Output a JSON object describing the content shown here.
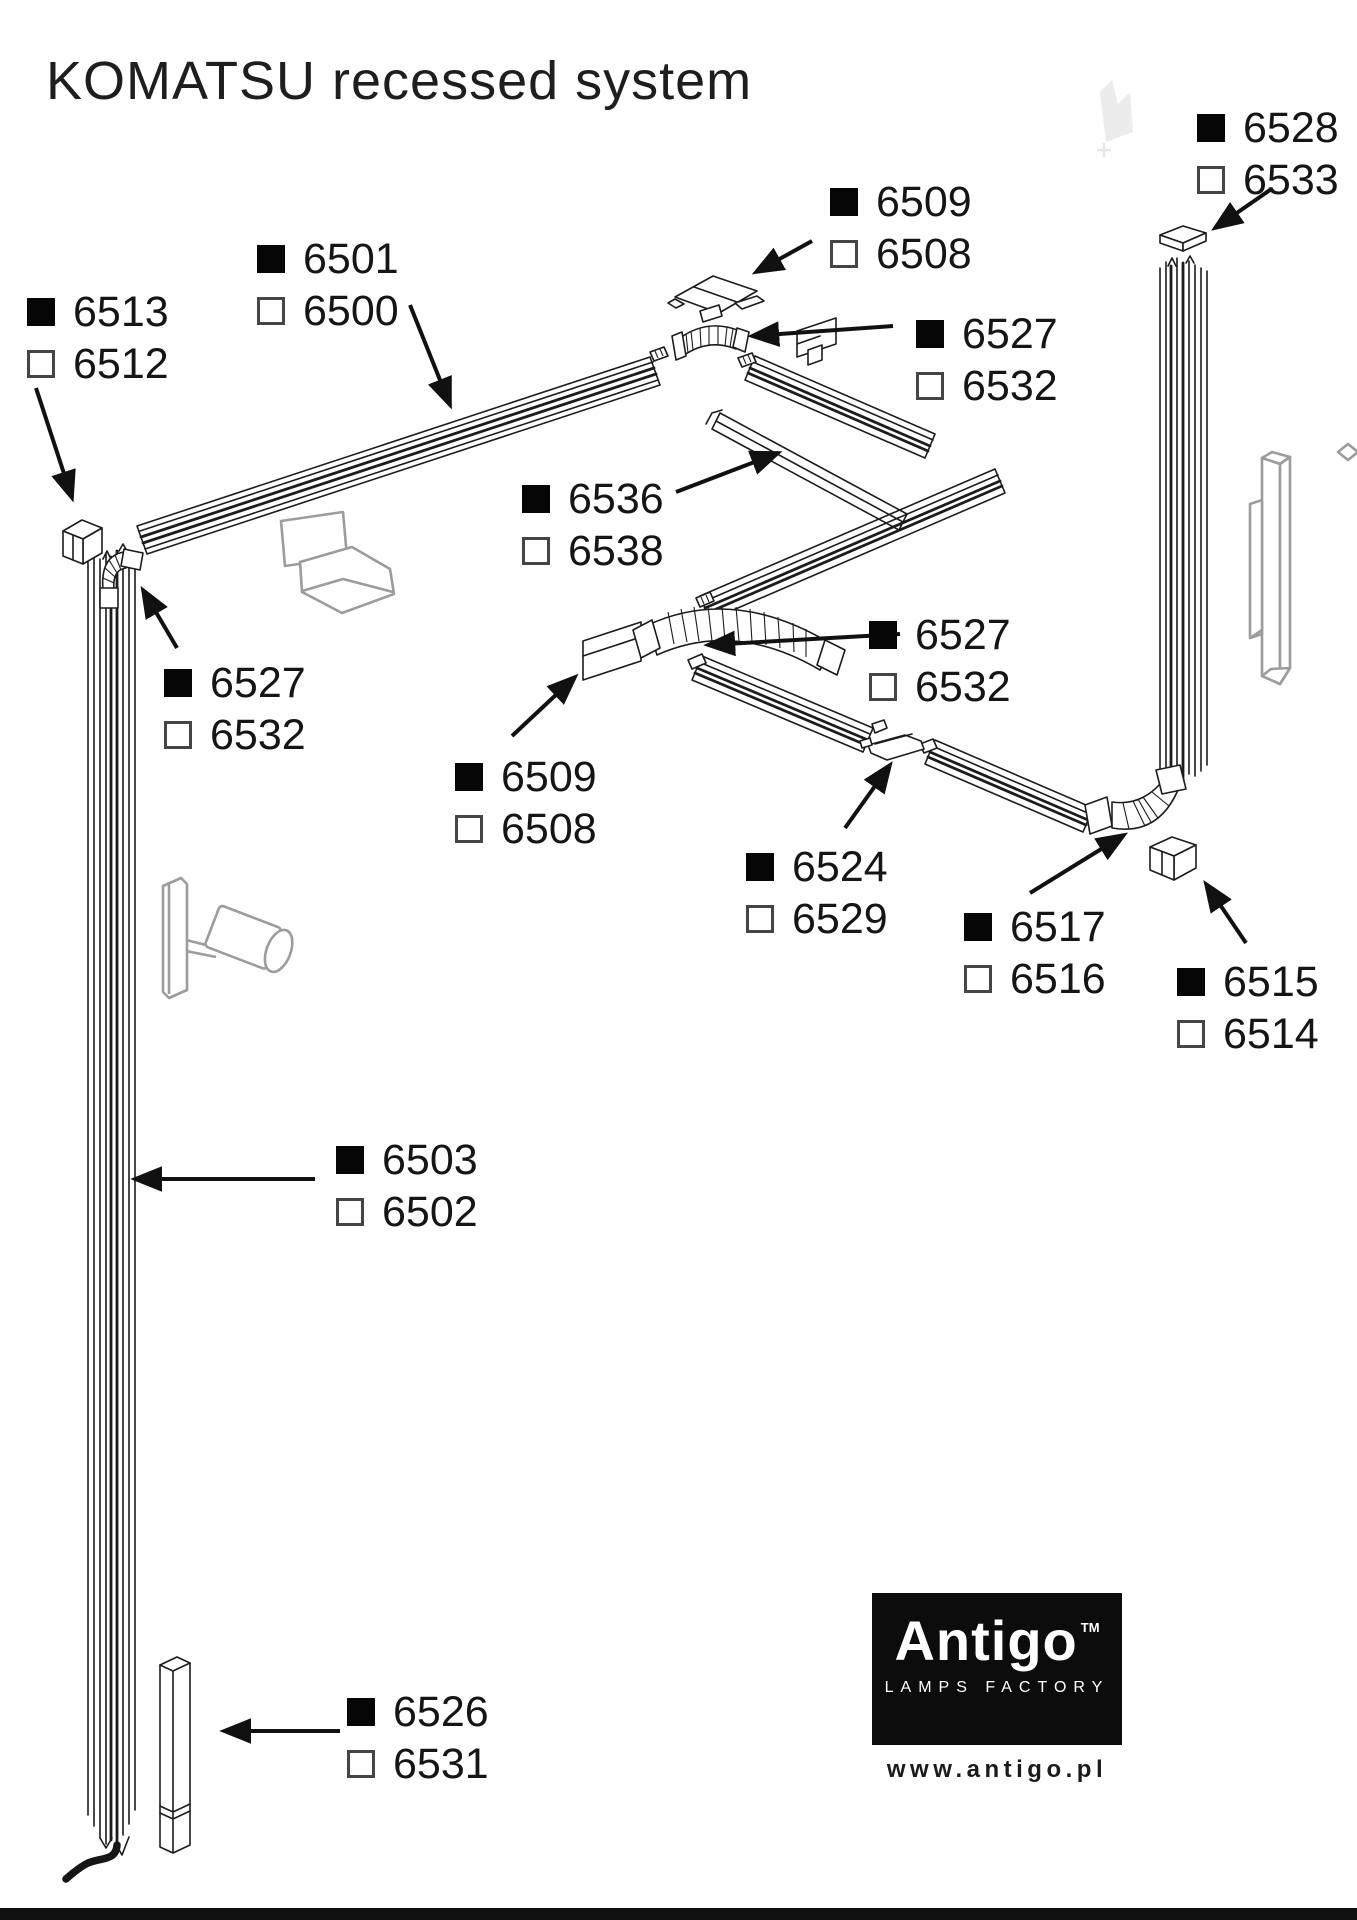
{
  "title": "KOMATSU recessed system",
  "labels": [
    {
      "id": "6513-6512",
      "black": "6513",
      "white": "6512"
    },
    {
      "id": "6501-6500",
      "black": "6501",
      "white": "6500"
    },
    {
      "id": "6509-6508-a",
      "black": "6509",
      "white": "6508"
    },
    {
      "id": "6528-6533",
      "black": "6528",
      "white": "6533"
    },
    {
      "id": "6527-6532-a",
      "black": "6527",
      "white": "6532"
    },
    {
      "id": "6536-6538",
      "black": "6536",
      "white": "6538"
    },
    {
      "id": "6527-6532-b",
      "black": "6527",
      "white": "6532"
    },
    {
      "id": "6527-6532-c",
      "black": "6527",
      "white": "6532"
    },
    {
      "id": "6509-6508-b",
      "black": "6509",
      "white": "6508"
    },
    {
      "id": "6524-6529",
      "black": "6524",
      "white": "6529"
    },
    {
      "id": "6517-6516",
      "black": "6517",
      "white": "6516"
    },
    {
      "id": "6515-6514",
      "black": "6515",
      "white": "6514"
    },
    {
      "id": "6503-6502",
      "black": "6503",
      "white": "6502"
    },
    {
      "id": "6526-6531",
      "black": "6526",
      "white": "6531"
    }
  ],
  "logo": {
    "brand": "Antigo",
    "trademark": "TM",
    "tagline": "LAMPS FACTORY",
    "website": "www.antigo.pl"
  },
  "colors": {
    "line": "#1c1c1c",
    "gray_fixture": "#9c9c9c",
    "logo_background": "#0c0c0c"
  }
}
